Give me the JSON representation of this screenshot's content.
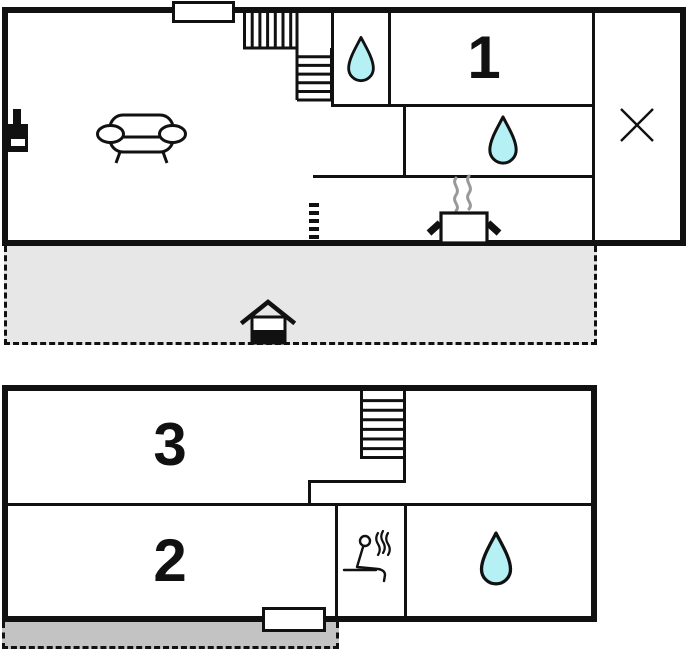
{
  "document": {
    "kind": "two-storey holiday-home floor plan",
    "floors": 2
  },
  "rooms": {
    "room1": {
      "label": "1",
      "floor": "upper",
      "type": "bedroom"
    },
    "room2": {
      "label": "2",
      "floor": "lower",
      "type": "bedroom"
    },
    "room3": {
      "label": "3",
      "floor": "lower",
      "type": "bedroom"
    }
  },
  "colors": {
    "wall": "#111111",
    "water_drop": "#b5f1f4",
    "upper_terrace_fill": "#e7e7e7",
    "lower_patio_fill": "#c3c3c3",
    "steam_gray": "#999999",
    "icon_black": "#111111"
  },
  "icons": {
    "upper_floor": [
      "window-icon",
      "winder-stairs-icon",
      "water-drop-icon",
      "water-drop-icon",
      "cross-icon",
      "wood-stove-icon",
      "sofa-icon",
      "cooking-pot-icon",
      "steam-icon",
      "dashed-partition"
    ],
    "terrace": [
      "house-entrance-icon"
    ],
    "lower_floor": [
      "stairs-icon",
      "sauna-icon",
      "water-drop-icon",
      "window-icon"
    ]
  }
}
